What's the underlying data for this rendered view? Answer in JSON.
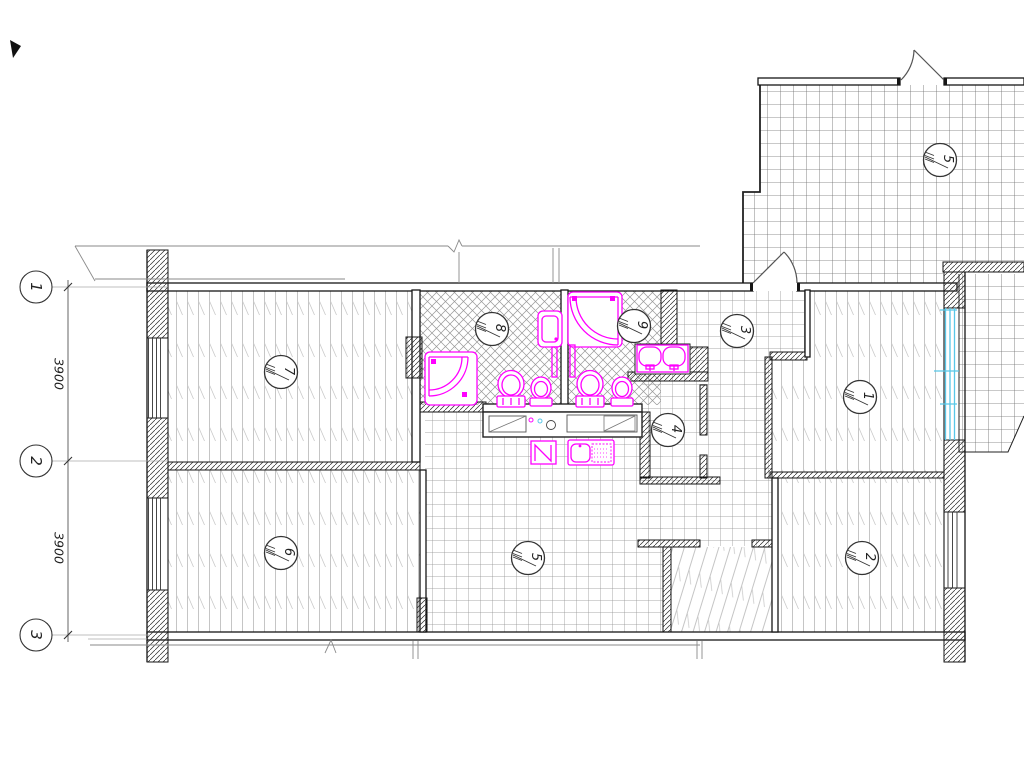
{
  "drawing": {
    "axes": {
      "a1": "1",
      "a2": "2",
      "a3": "3"
    },
    "dims": {
      "d1": "3900",
      "d2": "3900"
    },
    "rooms": {
      "r7": "7",
      "r8": "8",
      "r9": "9",
      "r3": "3",
      "r1": "1",
      "r4": "4",
      "r6": "6",
      "r5_hall": "5",
      "r2": "2",
      "r5_terrace": "5"
    },
    "colors": {
      "fixture": "#ff00ff",
      "window_glass": "#58c7e8",
      "line": "#161616"
    }
  }
}
